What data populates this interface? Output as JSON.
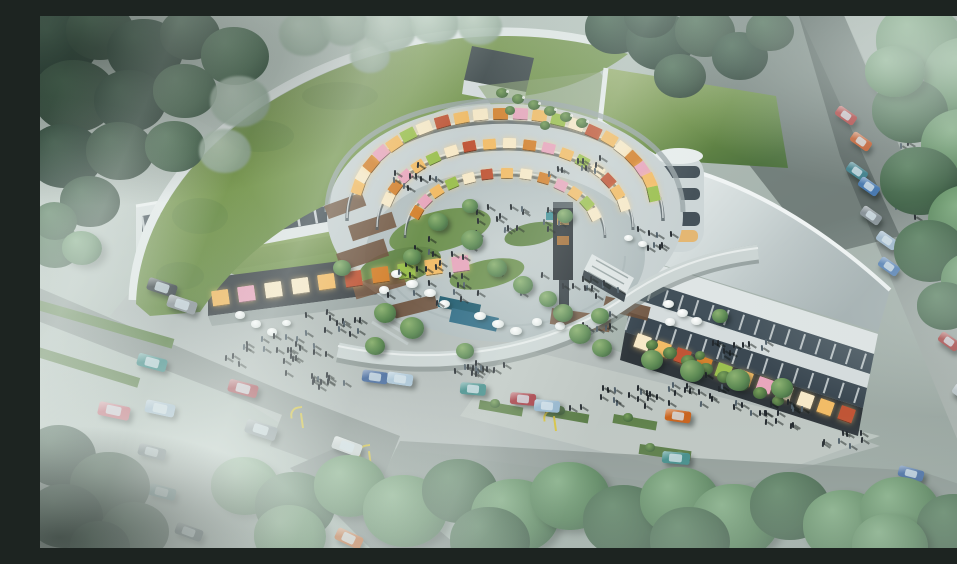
{
  "meta": {
    "title": "Aerial architectural rendering of a crescent-shaped mixed-use shopping complex",
    "description": "Bird's-eye 3D visualization: a crescent building with grass roofs wraps a circular galleria courtyard with glowing storefronts, terraces, umbrellas, a footbridge, crowds of pedestrians, surrounding tree-lined roads with parked and moving cars, soft fog and light rays."
  },
  "palette": {
    "lamp": "#d6c13b",
    "person": "#242a2f",
    "person_alt": "#51606a",
    "glow_cycle": [
      "#f2bc67",
      "#f7e9c8",
      "#d4822f",
      "#e8a7bd",
      "#f2bc67",
      "#9cc050",
      "#f7e9c8",
      "#c05536"
    ],
    "t_d1": {
      "hi": "#3f5e4a",
      "mid": "#2a4236",
      "lo": "#1d2f27"
    },
    "t_d2": {
      "hi": "#4a6b53",
      "mid": "#364f3f",
      "lo": "#24362c"
    },
    "t_m": {
      "hi": "#5f8465",
      "mid": "#47684e",
      "lo": "#2f4838"
    },
    "t_b": {
      "hi": "#84ae85",
      "mid": "#5a855d",
      "lo": "#3a5a42"
    },
    "t_p": {
      "hi": "#c2d4c4",
      "mid": "#a3b9a8",
      "lo": "#84998a"
    }
  },
  "entities": {
    "cars": [
      [
        107,
        265,
        30,
        13,
        18,
        "#3a4146"
      ],
      [
        127,
        282,
        30,
        13,
        18,
        "#8f979c"
      ],
      [
        97,
        340,
        30,
        13,
        15,
        "#3f8b88"
      ],
      [
        188,
        366,
        30,
        13,
        15,
        "#a33a44"
      ],
      [
        58,
        388,
        32,
        14,
        12,
        "#c4606e"
      ],
      [
        105,
        386,
        30,
        13,
        12,
        "#9fb9cd"
      ],
      [
        205,
        407,
        32,
        14,
        18,
        "#7f8a90"
      ],
      [
        98,
        430,
        28,
        12,
        15,
        "#5c6a72"
      ],
      [
        108,
        470,
        28,
        12,
        15,
        "#49797f"
      ],
      [
        135,
        510,
        28,
        12,
        20,
        "#3c4a52"
      ],
      [
        295,
        516,
        28,
        13,
        25,
        "#c26430"
      ],
      [
        308,
        477,
        28,
        12,
        22,
        "#8ea8bc"
      ],
      [
        292,
        424,
        30,
        13,
        20,
        "#cfd6d6"
      ],
      [
        322,
        355,
        26,
        12,
        8,
        "#44689c"
      ],
      [
        347,
        357,
        26,
        12,
        8,
        "#a8c3d6"
      ],
      [
        420,
        367,
        26,
        12,
        5,
        "#3e8a87"
      ],
      [
        470,
        377,
        26,
        12,
        5,
        "#a53a42"
      ],
      [
        494,
        384,
        26,
        12,
        5,
        "#93b4cc"
      ],
      [
        625,
        394,
        26,
        12,
        8,
        "#c9641f"
      ],
      [
        622,
        436,
        28,
        12,
        5,
        "#3f8b88"
      ],
      [
        858,
        452,
        26,
        11,
        15,
        "#4a6fa5"
      ],
      [
        795,
        94,
        22,
        11,
        35,
        "#b03a3a"
      ],
      [
        810,
        120,
        22,
        11,
        35,
        "#c25a2c"
      ],
      [
        806,
        150,
        22,
        11,
        35,
        "#3f7f8b"
      ],
      [
        818,
        165,
        22,
        11,
        35,
        "#4a7ab0"
      ],
      [
        820,
        194,
        22,
        11,
        35,
        "#8a949a"
      ],
      [
        836,
        219,
        22,
        11,
        35,
        "#9fb8cd"
      ],
      [
        838,
        245,
        22,
        11,
        35,
        "#5580b5"
      ],
      [
        898,
        320,
        22,
        11,
        35,
        "#a84444"
      ],
      [
        912,
        372,
        22,
        11,
        35,
        "#b8c2c6"
      ],
      [
        928,
        428,
        22,
        11,
        35,
        "#c4ccd0"
      ]
    ],
    "trees": [
      [
        18,
        28,
        40,
        "d1"
      ],
      [
        60,
        15,
        34,
        "d2"
      ],
      [
        105,
        35,
        38,
        "d1"
      ],
      [
        150,
        18,
        30,
        "d2"
      ],
      [
        195,
        40,
        34,
        "m"
      ],
      [
        35,
        80,
        42,
        "d2"
      ],
      [
        90,
        85,
        36,
        "d1"
      ],
      [
        145,
        75,
        32,
        "m"
      ],
      [
        200,
        85,
        30,
        "p"
      ],
      [
        25,
        140,
        38,
        "d1"
      ],
      [
        80,
        135,
        34,
        "d2"
      ],
      [
        135,
        130,
        30,
        "m"
      ],
      [
        185,
        135,
        26,
        "p"
      ],
      [
        50,
        185,
        30,
        "d2"
      ],
      [
        15,
        230,
        26,
        "m"
      ],
      [
        265,
        18,
        26,
        "p"
      ],
      [
        305,
        10,
        24,
        "p"
      ],
      [
        350,
        14,
        26,
        "p"
      ],
      [
        395,
        8,
        24,
        "p"
      ],
      [
        440,
        10,
        22,
        "p"
      ],
      [
        330,
        40,
        20,
        "p"
      ],
      [
        575,
        12,
        30,
        "d1"
      ],
      [
        620,
        25,
        34,
        "d1"
      ],
      [
        665,
        15,
        30,
        "d2"
      ],
      [
        700,
        40,
        28,
        "d1"
      ],
      [
        640,
        60,
        26,
        "d2"
      ],
      [
        610,
        0,
        26,
        "d1"
      ],
      [
        730,
        15,
        24,
        "d2"
      ],
      [
        880,
        25,
        44,
        "b"
      ],
      [
        930,
        60,
        46,
        "b"
      ],
      [
        870,
        95,
        38,
        "m"
      ],
      [
        925,
        130,
        44,
        "b"
      ],
      [
        880,
        165,
        40,
        "m"
      ],
      [
        930,
        205,
        42,
        "b"
      ],
      [
        890,
        235,
        36,
        "m"
      ],
      [
        935,
        265,
        34,
        "b"
      ],
      [
        855,
        55,
        30,
        "b"
      ],
      [
        905,
        290,
        28,
        "m"
      ],
      [
        205,
        470,
        34,
        "b"
      ],
      [
        255,
        490,
        40,
        "m"
      ],
      [
        310,
        470,
        36,
        "b"
      ],
      [
        365,
        495,
        42,
        "b"
      ],
      [
        420,
        475,
        38,
        "m"
      ],
      [
        475,
        500,
        44,
        "b"
      ],
      [
        530,
        480,
        40,
        "b"
      ],
      [
        585,
        505,
        42,
        "m"
      ],
      [
        640,
        485,
        40,
        "b"
      ],
      [
        695,
        505,
        44,
        "b"
      ],
      [
        750,
        490,
        40,
        "m"
      ],
      [
        805,
        510,
        42,
        "b"
      ],
      [
        860,
        495,
        40,
        "b"
      ],
      [
        915,
        510,
        38,
        "m"
      ],
      [
        250,
        520,
        36,
        "b"
      ],
      [
        450,
        525,
        40,
        "m"
      ],
      [
        650,
        525,
        40,
        "m"
      ],
      [
        850,
        530,
        38,
        "b"
      ],
      [
        20,
        440,
        36,
        "d1"
      ],
      [
        70,
        470,
        40,
        "d2"
      ],
      [
        25,
        500,
        38,
        "d1"
      ],
      [
        95,
        515,
        34,
        "d2"
      ],
      [
        60,
        530,
        30,
        "d1"
      ],
      [
        15,
        205,
        22,
        "m"
      ],
      [
        42,
        232,
        20,
        "b"
      ]
    ],
    "smalltrees": [
      [
        345,
        297,
        11
      ],
      [
        372,
        312,
        12
      ],
      [
        302,
        252,
        9
      ],
      [
        523,
        297,
        10
      ],
      [
        540,
        318,
        11
      ],
      [
        562,
        332,
        10
      ],
      [
        612,
        344,
        11
      ],
      [
        652,
        355,
        12
      ],
      [
        698,
        364,
        12
      ],
      [
        742,
        372,
        11
      ],
      [
        398,
        206,
        10
      ],
      [
        432,
        224,
        11
      ],
      [
        372,
        241,
        9
      ],
      [
        457,
        252,
        10
      ],
      [
        483,
        269,
        10
      ],
      [
        508,
        283,
        9
      ],
      [
        525,
        200,
        8
      ],
      [
        560,
        300,
        9
      ],
      [
        430,
        190,
        8
      ],
      [
        680,
        300,
        8
      ],
      [
        335,
        330,
        10
      ],
      [
        425,
        335,
        9
      ]
    ],
    "shrubs": [
      [
        462,
        78,
        6
      ],
      [
        478,
        84,
        6
      ],
      [
        494,
        90,
        6
      ],
      [
        510,
        96,
        6
      ],
      [
        526,
        102,
        6
      ],
      [
        542,
        108,
        6
      ],
      [
        470,
        95,
        5
      ],
      [
        505,
        110,
        5
      ],
      [
        612,
        330,
        6
      ],
      [
        630,
        338,
        7
      ],
      [
        648,
        346,
        7
      ],
      [
        666,
        354,
        7
      ],
      [
        684,
        362,
        7
      ],
      [
        702,
        370,
        7
      ],
      [
        720,
        378,
        7
      ],
      [
        738,
        386,
        6
      ],
      [
        660,
        340,
        5
      ],
      [
        700,
        360,
        5
      ],
      [
        455,
        388,
        5
      ],
      [
        520,
        395,
        5
      ],
      [
        588,
        402,
        5
      ],
      [
        610,
        432,
        5
      ],
      [
        640,
        440,
        5
      ]
    ],
    "flowers": [
      [
        466,
        74
      ],
      [
        482,
        80
      ],
      [
        498,
        86
      ],
      [
        514,
        92
      ],
      [
        530,
        98
      ],
      [
        546,
        104
      ]
    ],
    "crowds": [
      [
        235,
        332,
        26,
        60,
        26
      ],
      [
        300,
        305,
        12,
        40,
        14
      ],
      [
        430,
        352,
        14,
        45,
        14
      ],
      [
        560,
        302,
        10,
        30,
        12
      ],
      [
        645,
        372,
        22,
        70,
        20
      ],
      [
        735,
        392,
        14,
        45,
        16
      ],
      [
        800,
        420,
        8,
        35,
        10
      ],
      [
        875,
        170,
        14,
        25,
        70
      ],
      [
        900,
        75,
        8,
        20,
        35
      ],
      [
        430,
        255,
        28,
        85,
        38
      ],
      [
        480,
        200,
        16,
        60,
        22
      ],
      [
        545,
        268,
        12,
        35,
        14
      ],
      [
        380,
        160,
        10,
        48,
        16
      ],
      [
        540,
        148,
        10,
        48,
        14
      ],
      [
        615,
        222,
        8,
        22,
        22
      ],
      [
        690,
        330,
        10,
        40,
        12
      ],
      [
        280,
        360,
        10,
        30,
        10
      ],
      [
        570,
        380,
        12,
        50,
        14
      ]
    ],
    "umbrellas": [
      [
        356,
        258,
        11
      ],
      [
        372,
        268,
        12
      ],
      [
        390,
        277,
        12
      ],
      [
        344,
        274,
        10
      ],
      [
        404,
        288,
        11
      ],
      [
        440,
        300,
        12
      ],
      [
        458,
        308,
        12
      ],
      [
        476,
        315,
        12
      ],
      [
        497,
        306,
        10
      ],
      [
        588,
        222,
        9
      ],
      [
        602,
        228,
        9
      ],
      [
        628,
        288,
        11
      ],
      [
        642,
        297,
        11
      ],
      [
        656,
        305,
        11
      ],
      [
        630,
        306,
        10
      ],
      [
        200,
        299,
        10
      ],
      [
        216,
        308,
        10
      ],
      [
        232,
        316,
        10
      ],
      [
        246,
        307,
        9
      ],
      [
        520,
        310,
        10
      ]
    ],
    "lamps": [
      [
        262,
        412
      ],
      [
        330,
        450
      ],
      [
        515,
        415
      ]
    ],
    "galleria_rings": [
      {
        "cx": 465,
        "cy": 190,
        "rx": 150,
        "ry": 93,
        "a0": 192,
        "a1": 352,
        "n": 22,
        "w": 15,
        "h": 11
      },
      {
        "cx": 465,
        "cy": 204,
        "rx": 121,
        "ry": 77,
        "a0": 196,
        "a1": 348,
        "n": 17,
        "w": 13,
        "h": 10
      },
      {
        "cx": 465,
        "cy": 216,
        "rx": 94,
        "ry": 59,
        "a0": 200,
        "a1": 342,
        "n": 13,
        "w": 12,
        "h": 10
      }
    ],
    "storefront_rows": [
      {
        "x0": 180,
        "y0": 281,
        "x1": 420,
        "y1": 247,
        "n": 10,
        "w": 17,
        "h": 15
      },
      {
        "x0": 602,
        "y0": 326,
        "x1": 806,
        "y1": 398,
        "n": 11,
        "w": 15,
        "h": 14
      }
    ]
  }
}
